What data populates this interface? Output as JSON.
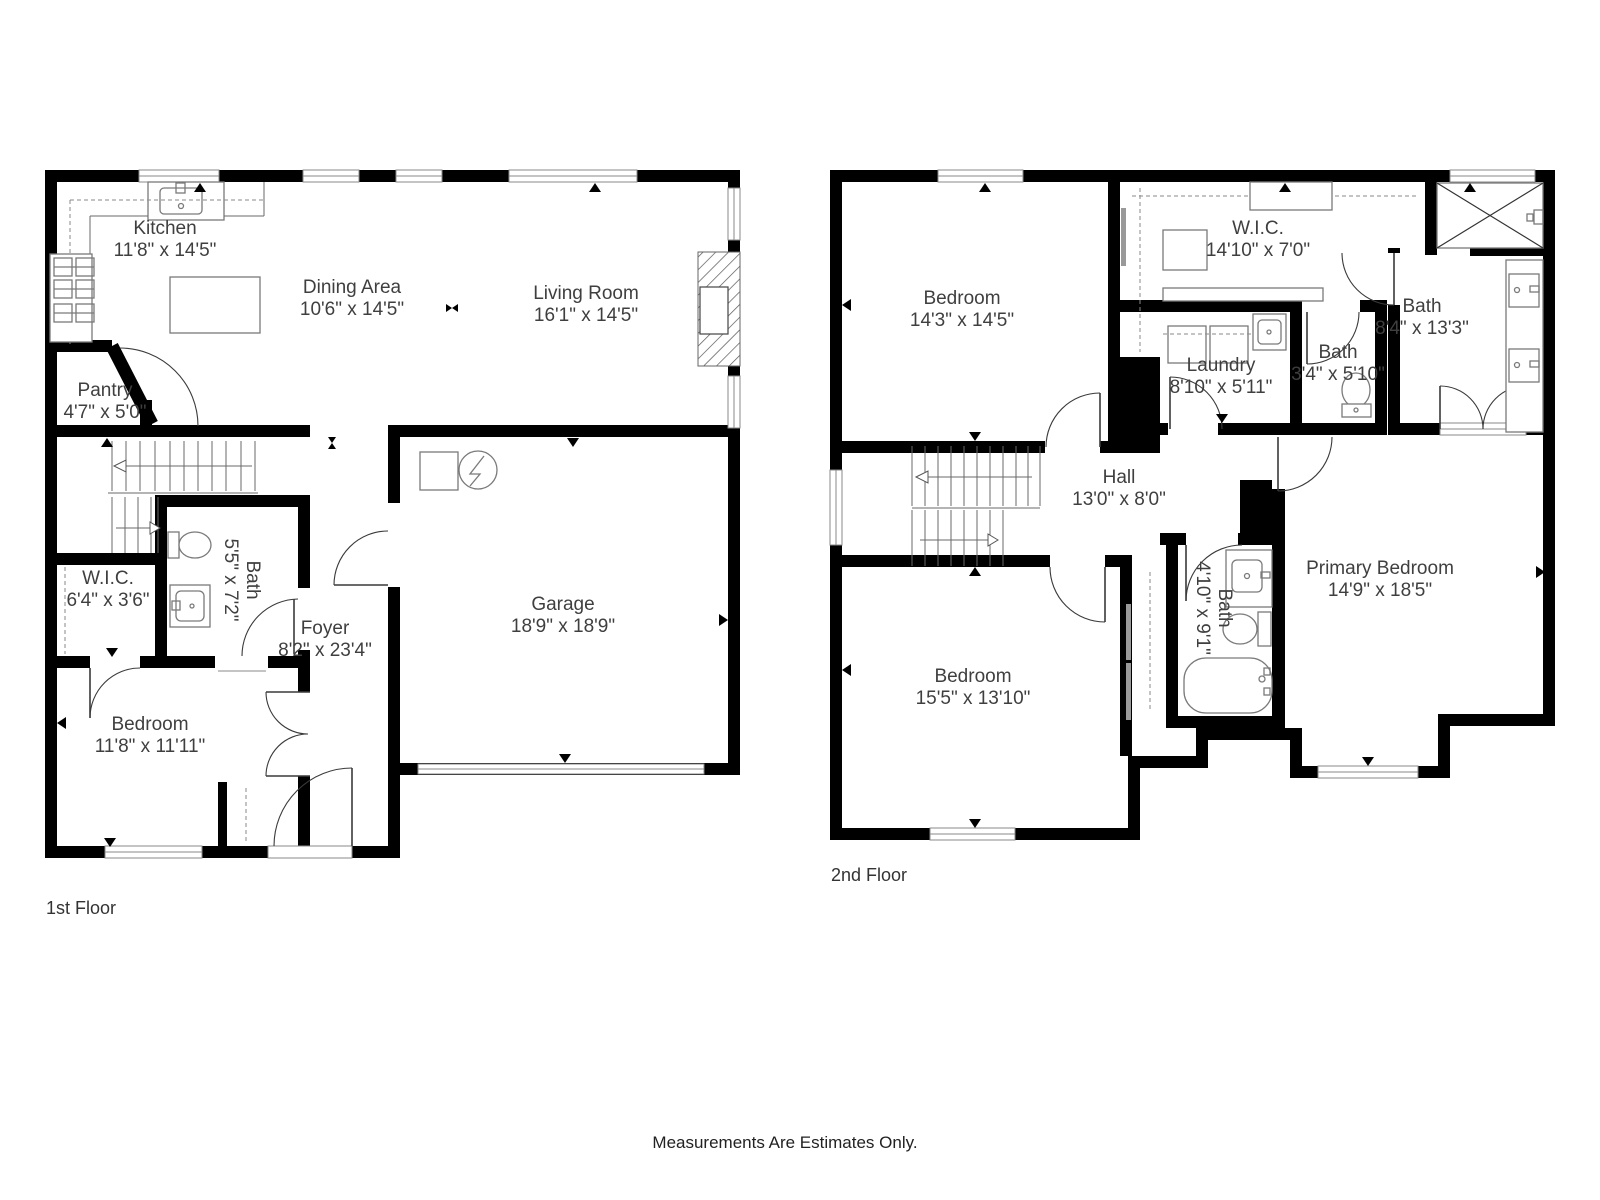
{
  "colors": {
    "wall": "#000000",
    "text": "#3f3f3f",
    "fixture": "#7a7a7a"
  },
  "footer": {
    "disclaimer": "Measurements Are Estimates Only."
  },
  "floor1": {
    "label": "1st Floor",
    "rooms": {
      "kitchen": {
        "name": "Kitchen",
        "dims": "11'8\" x 14'5\""
      },
      "dining": {
        "name": "Dining Area",
        "dims": "10'6\" x 14'5\""
      },
      "living": {
        "name": "Living Room",
        "dims": "16'1\" x 14'5\""
      },
      "pantry": {
        "name": "Pantry",
        "dims": "4'7\" x 5'0\""
      },
      "bath": {
        "name": "Bath",
        "dims": "5'5\" x 7'2\""
      },
      "wic": {
        "name": "W.I.C.",
        "dims": "6'4\" x 3'6\""
      },
      "foyer": {
        "name": "Foyer",
        "dims": "8'2\" x 23'4\""
      },
      "garage": {
        "name": "Garage",
        "dims": "18'9\" x 18'9\""
      },
      "bedroom": {
        "name": "Bedroom",
        "dims": "11'8\" x 11'11\""
      }
    }
  },
  "floor2": {
    "label": "2nd Floor",
    "rooms": {
      "bedroom_tl": {
        "name": "Bedroom",
        "dims": "14'3\" x 14'5\""
      },
      "wic": {
        "name": "W.I.C.",
        "dims": "14'10\" x 7'0\""
      },
      "bath_main": {
        "name": "Bath",
        "dims": "8'4\" x 13'3\""
      },
      "laundry": {
        "name": "Laundry",
        "dims": "8'10\" x 5'11\""
      },
      "bath_small": {
        "name": "Bath",
        "dims": "3'4\" x 5'10\""
      },
      "hall": {
        "name": "Hall",
        "dims": "13'0\" x 8'0\""
      },
      "primary": {
        "name": "Primary Bedroom",
        "dims": "14'9\" x 18'5\""
      },
      "bath_ens": {
        "name": "Bath",
        "dims": "4'10\" x 9'1\""
      },
      "bedroom_b": {
        "name": "Bedroom",
        "dims": "15'5\" x 13'10\""
      }
    }
  }
}
